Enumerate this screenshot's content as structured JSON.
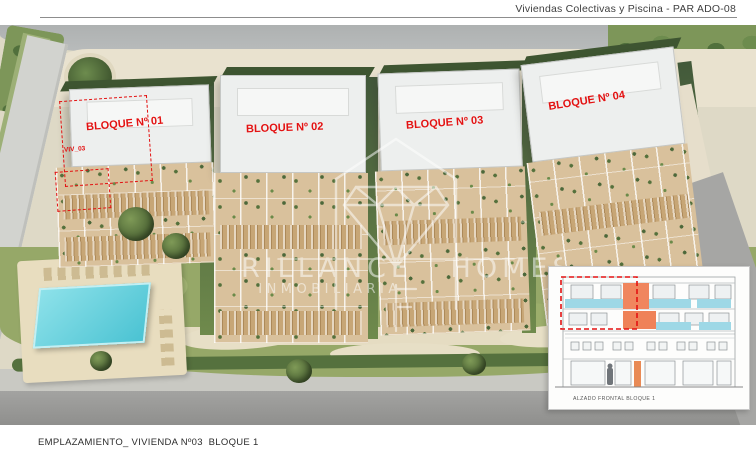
{
  "header": {
    "title": "Viviendas Colectivas y Piscina - PAR ADO-08"
  },
  "plan": {
    "blocks": [
      {
        "label": "BLOQUE Nº 01"
      },
      {
        "label": "BLOQUE Nº 02"
      },
      {
        "label": "BLOQUE Nº 03"
      },
      {
        "label": "BLOQUE Nº 04"
      }
    ],
    "unit_label": "VIV_03",
    "label_color": "#e31212"
  },
  "pool": {
    "water_color": "#55cdd9"
  },
  "watermark": {
    "icon": "diamond-house-logo",
    "line1": "BRILLANCE HOMES",
    "line2": "INMOBILIARIA",
    "color": "#ffffff"
  },
  "inset": {
    "caption": "ALZADO FRONTAL BLOQUE 1",
    "highlight_color": "#f0865e",
    "glass_color": "#9ed8e6",
    "outline_color": "#e31212"
  },
  "footer": {
    "caption": "EMPLAZAMIENTO_ VIVIENDA Nº03  BLOQUE 1"
  }
}
